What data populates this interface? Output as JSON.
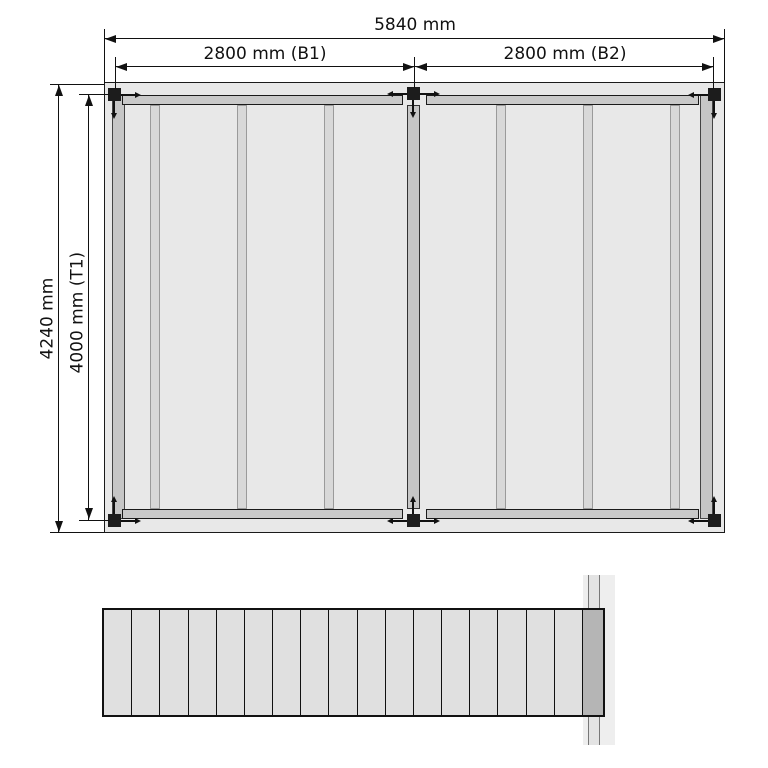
{
  "labels": {
    "total_width": "5840 mm",
    "bay1": "2800 mm (B1)",
    "bay2": "2800 mm (B2)",
    "total_depth": "4240 mm",
    "inner_depth": "4000 mm (T1)"
  },
  "plan": {
    "bay_count": 2,
    "post_count": 6,
    "joist_count": 9
  },
  "elevation": {
    "board_count": 18,
    "dark_end_board": true
  },
  "colors": {
    "background": "#ffffff",
    "deck_fill": "#e8e8e8",
    "beam_fill": "#c9c9c9",
    "joist_fill": "#d8d8d8",
    "rim_joist_fill": "#c6c6c6",
    "post_fill": "#1c1c1c",
    "board_fill": "#e0e0e0",
    "end_board_fill": "#b5b5b5",
    "line_color": "#111111"
  }
}
